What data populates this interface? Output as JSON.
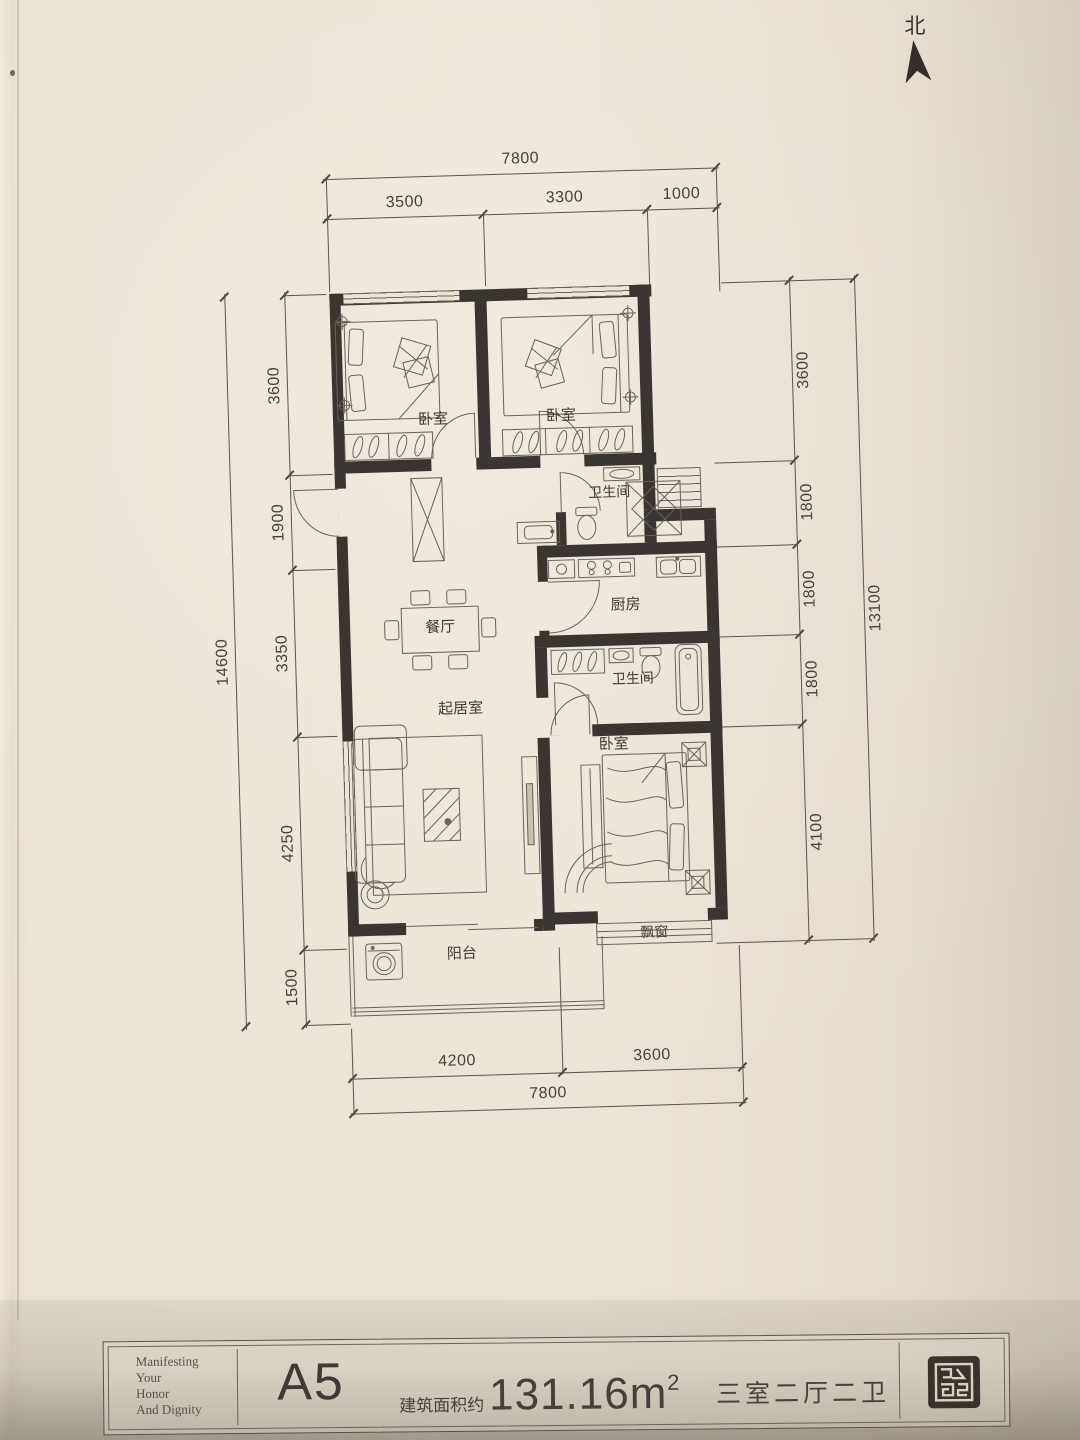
{
  "compass": {
    "label": "北"
  },
  "dimensions": {
    "top": {
      "total": "7800",
      "segments": [
        "3500",
        "3300",
        "1000"
      ]
    },
    "bottom": {
      "total": "7800",
      "segments": [
        "4200",
        "3600"
      ]
    },
    "left": {
      "total": "14600",
      "segments": [
        "3600",
        "1900",
        "3350",
        "4250",
        "1500"
      ]
    },
    "right": {
      "total": "13100",
      "segments": [
        "3600",
        "1800",
        "1800",
        "1800",
        "4100"
      ]
    }
  },
  "rooms": {
    "bedroom_top_left": "卧室",
    "bedroom_top_right": "卧室",
    "bathroom_upper": "卫生间",
    "kitchen": "厨房",
    "dining": "餐厅",
    "bathroom_lower": "卫生间",
    "living": "起居室",
    "bedroom_master": "卧室",
    "bay_window": "飘窗",
    "balcony": "阳台"
  },
  "title_block": {
    "slogan_lines": [
      "Manifesting",
      "Your",
      "Honor",
      "And Dignity"
    ],
    "unit_name": "A5",
    "area_label": "建筑面积约",
    "area_value": "131.16m",
    "area_superscript": "2",
    "layout_type": "三室二厅二卫"
  },
  "colors": {
    "ink": "#3a3531",
    "paper": "#e8e0d1",
    "line": "#6a6259"
  }
}
